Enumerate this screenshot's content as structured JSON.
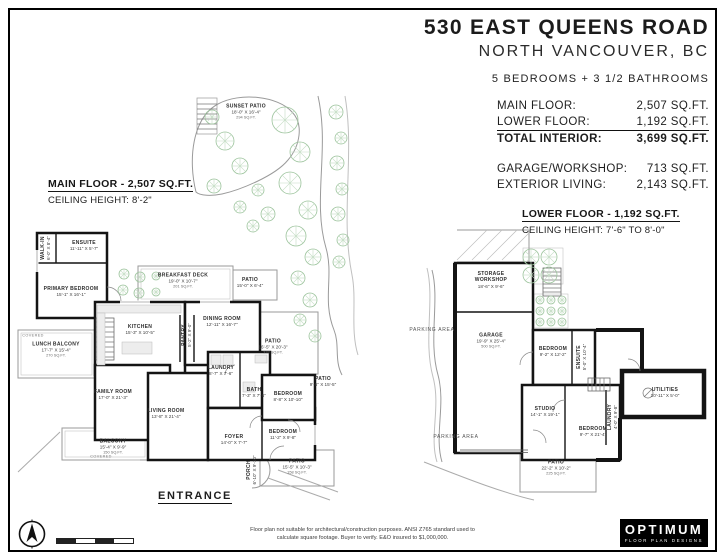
{
  "header": {
    "title": "530 EAST QUEENS ROAD",
    "subtitle": "NORTH VANCOUVER, BC",
    "beds_baths": "5 BEDROOMS + 3 1/2 BATHROOMS",
    "stats": [
      {
        "label": "MAIN FLOOR:",
        "value": "2,507 SQ.FT."
      },
      {
        "label": "LOWER FLOOR:",
        "value": "1,192 SQ.FT."
      },
      {
        "label": "TOTAL INTERIOR:",
        "value": "3,699 SQ.FT."
      }
    ],
    "stats2": [
      {
        "label": "GARAGE/WORKSHOP:",
        "value": "713 SQ.FT."
      },
      {
        "label": "EXTERIOR LIVING:",
        "value": "2,143 SQ.FT."
      }
    ]
  },
  "main_floor": {
    "heading": "MAIN FLOOR - 2,507 SQ.FT.",
    "ceiling": "CEILING HEIGHT: 8'-2\"",
    "entrance_label": "ENTRANCE",
    "rooms": [
      {
        "label": "SUNSET PATIO",
        "dims": "18'-0\" X 16'-4\"",
        "area": "294 SQ.FT.",
        "x": 246,
        "y": 112
      },
      {
        "label": "WALK-IN",
        "dims": "6'-0\" X 8'-4\"",
        "x": 46,
        "y": 248,
        "vertical": true
      },
      {
        "label": "ENSUITE",
        "dims": "11'-11\" X 5'-7\"",
        "x": 84,
        "y": 246
      },
      {
        "label": "PRIMARY BEDROOM",
        "dims": "15'-1\" X 16'-1\"",
        "x": 71,
        "y": 292
      },
      {
        "label": "LUNCH BALCONY",
        "dims": "17'-7\" X 15'-4\"",
        "area": "270 SQ.FT.",
        "x": 56,
        "y": 350
      },
      {
        "label": "COVERED",
        "x": 33,
        "y": 336,
        "tiny": true
      },
      {
        "label": "BREAKFAST DECK",
        "dims": "19'-0\" X 10'-7\"",
        "area": "201 SQ.FT.",
        "x": 183,
        "y": 281
      },
      {
        "label": "PATIO",
        "dims": "15'-0\" X 6'-4\"",
        "x": 250,
        "y": 283
      },
      {
        "label": "KITCHEN",
        "dims": "15'-3\" X 10'-5\"",
        "x": 140,
        "y": 330
      },
      {
        "label": "PANTRY",
        "dims": "5'-2\" X 9'-0\"",
        "x": 187,
        "y": 335,
        "vertical": true
      },
      {
        "label": "DINING ROOM",
        "dims": "12'-11\" X 16'-7\"",
        "x": 222,
        "y": 322
      },
      {
        "label": "PATIO",
        "dims": "16'-5\" X 20'-3\"",
        "area": "332 SQ.FT.",
        "x": 273,
        "y": 347
      },
      {
        "label": "FAMILY ROOM",
        "dims": "17'-0\" X 21'-3\"",
        "x": 113,
        "y": 395
      },
      {
        "label": "LAUNDRY",
        "dims": "8'-7\" X 7'-6\"",
        "x": 221,
        "y": 371
      },
      {
        "label": "BATH",
        "dims": "7'-3\" X 7'-6\"",
        "x": 254,
        "y": 393
      },
      {
        "label": "LIVING ROOM",
        "dims": "13'-8\" X 21'-4\"",
        "x": 166,
        "y": 414
      },
      {
        "label": "BEDROOM",
        "dims": "8'-8\" X 10'-10\"",
        "x": 288,
        "y": 397
      },
      {
        "label": "PATIO",
        "dims": "9'-6\" X 15'-5\"",
        "x": 323,
        "y": 382
      },
      {
        "label": "BEDROOM",
        "dims": "11'-2\" X 9'-8\"",
        "x": 283,
        "y": 435
      },
      {
        "label": "FOYER",
        "dims": "14'-0\" X 7'-7\"",
        "x": 234,
        "y": 440
      },
      {
        "label": "BALCONY",
        "dims": "15'-4\" X 9'-9\"",
        "area": "150 SQ.FT.",
        "x": 113,
        "y": 447
      },
      {
        "label": "COVERED",
        "x": 101,
        "y": 457,
        "tiny": true
      },
      {
        "label": "PORCH",
        "dims": "6'-10\" X 9'-10\"",
        "x": 252,
        "y": 470,
        "vertical": true
      },
      {
        "label": "PATIO",
        "dims": "15'-5\" X 10'-3\"",
        "area": "158 SQ.FT.",
        "x": 297,
        "y": 467
      }
    ]
  },
  "lower_floor": {
    "heading": "LOWER FLOOR - 1,192 SQ.FT.",
    "ceiling": "CEILING HEIGHT: 7'-6\" TO 8'-0\"",
    "rooms": [
      {
        "label": "STORAGE",
        "label2": "WORKSHOP",
        "dims": "18'-6\" X 9'-6\"",
        "x": 491,
        "y": 280
      },
      {
        "label": "GARAGE",
        "dims": "19'-9\" X 25'-4\"",
        "area": "500 SQ.FT.",
        "x": 491,
        "y": 341
      },
      {
        "label": "PARKING AREA",
        "x": 432,
        "y": 330,
        "light": true
      },
      {
        "label": "BEDROOM",
        "dims": "9'-2\" X 12'-2\"",
        "x": 553,
        "y": 352
      },
      {
        "label": "ENSUITE",
        "dims": "5'-0\" X 10'-4\"",
        "x": 582,
        "y": 357,
        "vertical": true
      },
      {
        "label": "STUDIO",
        "dims": "14'-1\" X 19'-1\"",
        "x": 545,
        "y": 412
      },
      {
        "label": "BEDROOM",
        "dims": "9'-7\" X 21'-4\"",
        "x": 593,
        "y": 432
      },
      {
        "label": "LAUNDRY",
        "dims": "4'-0\" X 9'-8\"",
        "x": 613,
        "y": 417,
        "vertical": true
      },
      {
        "label": "UTILITIES",
        "dims": "10'-11\" X 5'-0\"",
        "x": 665,
        "y": 393
      },
      {
        "label": "PARKING AREA",
        "x": 456,
        "y": 437,
        "light": true
      },
      {
        "label": "PATIO",
        "dims": "22'-2\" X 10'-2\"",
        "area": "225 SQ.FT.",
        "x": 556,
        "y": 468
      }
    ]
  },
  "garden": {
    "trees": [
      [
        285,
        120,
        13
      ],
      [
        300,
        152,
        10
      ],
      [
        290,
        183,
        11
      ],
      [
        308,
        210,
        9
      ],
      [
        296,
        236,
        10
      ],
      [
        313,
        257,
        8
      ],
      [
        268,
        214,
        7
      ],
      [
        253,
        226,
        6
      ],
      [
        240,
        207,
        6
      ],
      [
        225,
        141,
        9
      ],
      [
        212,
        117,
        7
      ],
      [
        240,
        166,
        8
      ],
      [
        214,
        186,
        7
      ],
      [
        258,
        190,
        6
      ],
      [
        336,
        112,
        7
      ],
      [
        341,
        138,
        6
      ],
      [
        337,
        163,
        7
      ],
      [
        342,
        189,
        6
      ],
      [
        338,
        214,
        7
      ],
      [
        343,
        240,
        6
      ],
      [
        339,
        262,
        6
      ],
      [
        298,
        278,
        7
      ],
      [
        310,
        300,
        7
      ],
      [
        300,
        320,
        6
      ],
      [
        315,
        336,
        6
      ],
      [
        124,
        274,
        5
      ],
      [
        140,
        277,
        5
      ],
      [
        123,
        290,
        5
      ],
      [
        139,
        293,
        5
      ],
      [
        156,
        276,
        4
      ],
      [
        156,
        292,
        4
      ],
      [
        531,
        257,
        8
      ],
      [
        549,
        257,
        8
      ],
      [
        531,
        275,
        8
      ],
      [
        549,
        275,
        8
      ],
      [
        540,
        300,
        4
      ],
      [
        551,
        300,
        4
      ],
      [
        562,
        300,
        4
      ],
      [
        540,
        311,
        4
      ],
      [
        551,
        311,
        4
      ],
      [
        562,
        311,
        4
      ],
      [
        540,
        322,
        4
      ],
      [
        551,
        322,
        4
      ],
      [
        562,
        322,
        4
      ]
    ]
  },
  "footer": {
    "disclaimer_line1": "Floor plan not suitable for architectural/construction purposes. ANSI Z765 standard used to",
    "disclaimer_line2": "calculate square footage. Buyer to verify. E&O insured to $1,000,000.",
    "logo_name": "OPTIMUM",
    "logo_sub": "FLOOR PLAN DESIGNS"
  },
  "colors": {
    "wall": "#141414",
    "outdoor_line": "#9a9a9a",
    "tree_stroke": "#9dc49d",
    "tree_spoke": "#c3dcc3"
  }
}
